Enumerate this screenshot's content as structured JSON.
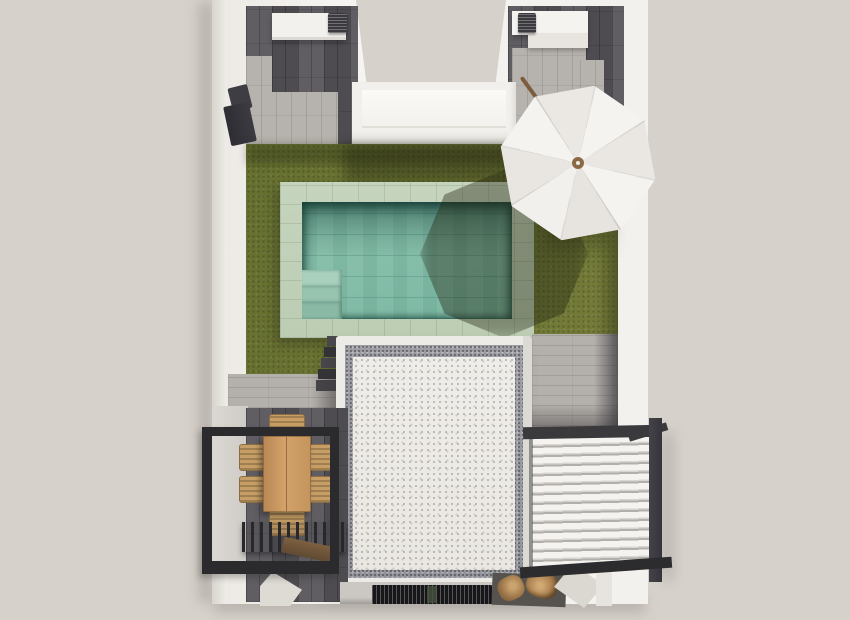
{
  "scene": {
    "type": "3d-architectural-render-top-view",
    "description": "Top-down 3D rendering of a villa roof terrace with pool, lawn, parasol, pergola dining area and louvered canopy",
    "labels": {
      "building": "Villa terrace (top view)",
      "left_patio": "Upper-left patio with wood-look tiles and stone path",
      "right_patio": "Upper-right patio with wood-look tiles and stone path",
      "ac_left": "Air-conditioning unit on planter box",
      "ac_right": "Air-conditioning unit on planter box",
      "wall_console": "Wall-mounted outdoor unit",
      "skylight": "White light-well between patios",
      "lawn": "Olive green lawn",
      "pool": "Swimming pool with turquoise tiled water",
      "pool_deck": "Sage tiled pool surround",
      "pool_steps": "Pool entry steps",
      "umbrella": "White octagonal parasol with tilted wooden pole",
      "roof_volume": "White gravel roof of lower building volume",
      "gravel_band": "Gray gravel perimeter strip",
      "stairs": "Dark steps beside roof volume",
      "pergola": "Black steel pergola frame over dining terrace",
      "dining_table": "Rectangular wooden dining table",
      "dining_chairs": "Six wicker dining chairs",
      "slat_roof": "Dark slatted pergola section",
      "bench": "Wooden bench",
      "louver_roof": "White louvered canopy with black frame",
      "drain_grate": "Black drainage grate",
      "logs": "Firewood logs",
      "corner_ramp": "White corner parapet"
    },
    "palette": {
      "background": "#d7d1cb",
      "wall_white": "#f3f1ed",
      "wood_dark_tile": "#57555a",
      "stone_light": "#b5b1ac",
      "lawn_green": "#6e7434",
      "shadow_green": "#3c4220",
      "pool_deck_sage": "#c0d0b8",
      "pool_water": "#85beaa",
      "pool_water_shadow": "#2e6a5c",
      "roof_white": "#edebe7",
      "roof_gravel_gray": "#9a9aa0",
      "frame_black": "#2c2b2e",
      "louver_white": "#f4f2ef",
      "table_wood": "#c austria",
      "chair_wicker": "#c79f66",
      "bench_wood": "#6d5438",
      "umbrella_white": "#f4f1ee",
      "pole_brown": "#7c5c3c"
    },
    "counts": {
      "dining_chairs": 6,
      "umbrella_panels": 8,
      "pool_steps": 3
    }
  }
}
